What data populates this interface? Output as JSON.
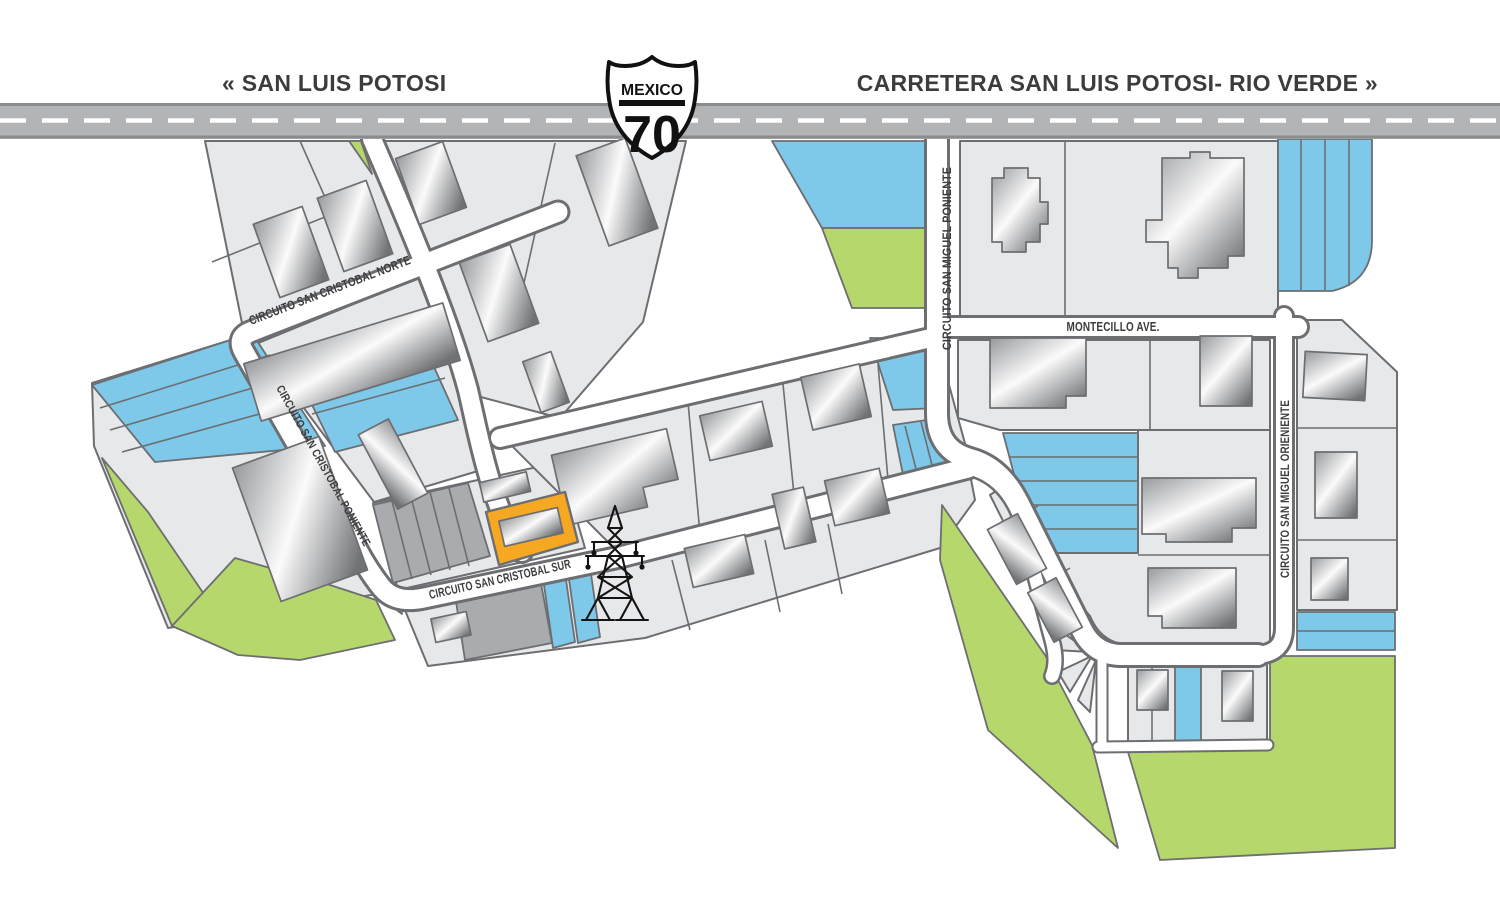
{
  "header": {
    "left_destination": "« SAN LUIS POTOSI",
    "right_destination": "CARRETERA SAN LUIS POTOSI- RIO VERDE »",
    "shield": {
      "country": "MEXICO",
      "route_number": "70"
    }
  },
  "streets": {
    "cristobal_norte": "CIRCUITO SAN CRISTOBAL NORTE",
    "cristobal_poniente": "CIRCUITO SAN CRISTOBAL PONIENTE",
    "cristobal_sur": "CIRCUITO SAN CRISTOBAL SUR",
    "miguel_poniente": "CIRCUITO SAN MIGUEL PONIENTE",
    "miguel_oriente": "CIRCUITO SAN MIGUEL ORIENIENTE",
    "montecillo": "MONTECILLO AVE."
  },
  "icons": {
    "transmission_tower": "transmission-tower-icon",
    "highway_shield": "mexico-route-70-shield"
  },
  "colors": {
    "accent": "#f7a823",
    "water": "#7ec9e9",
    "green": "#b5d76b",
    "parcel": "#e7e8e9",
    "dark": "#a9abae",
    "line": "#6d6e71",
    "hwy": "#b2b4b6",
    "hwyedge": "#8a8c8e",
    "ink": "#3c3c3e"
  }
}
